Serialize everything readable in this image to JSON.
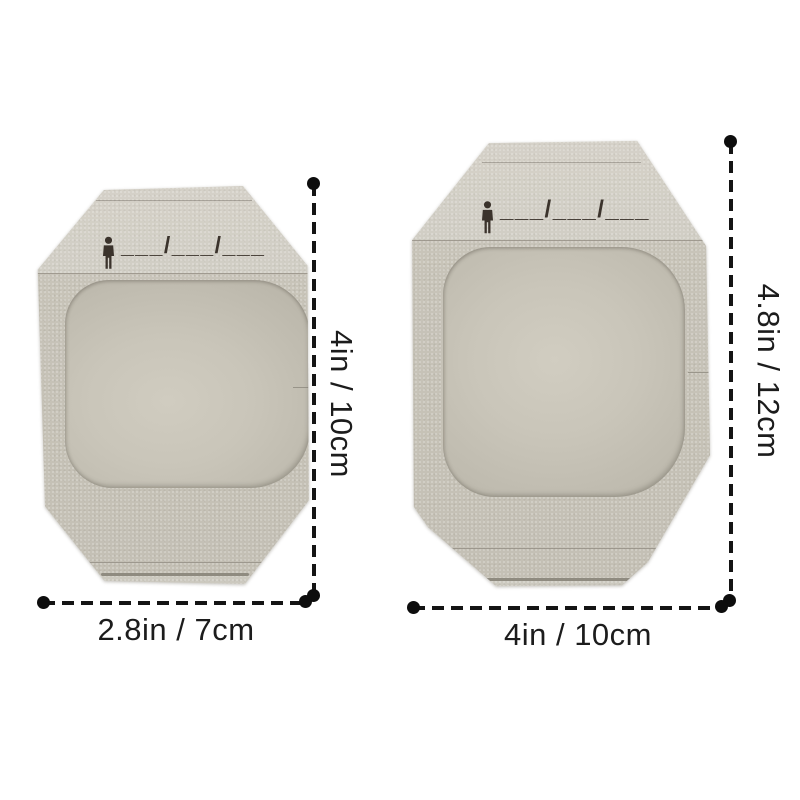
{
  "image_type": "product-dimension-diagram",
  "background_color": "#ffffff",
  "products": [
    {
      "id": "small-dressing",
      "date_placeholder": "___/___/___",
      "width_label": "2.8in / 7cm",
      "height_label": "4in / 10cm",
      "frame_color": "#c7c3b8",
      "window_color": "#c9c5b9",
      "print_color": "#3b332c"
    },
    {
      "id": "large-dressing",
      "date_placeholder": "___/___/___",
      "width_label": "4in / 10cm",
      "height_label": "4.8in / 12cm",
      "frame_color": "#c2beb3",
      "window_color": "#c8c4b8",
      "print_color": "#3b332c"
    }
  ],
  "annotation": {
    "line_color": "#141414",
    "text_color": "#1c1c1c",
    "line_style": "dashed-with-end-dots"
  }
}
